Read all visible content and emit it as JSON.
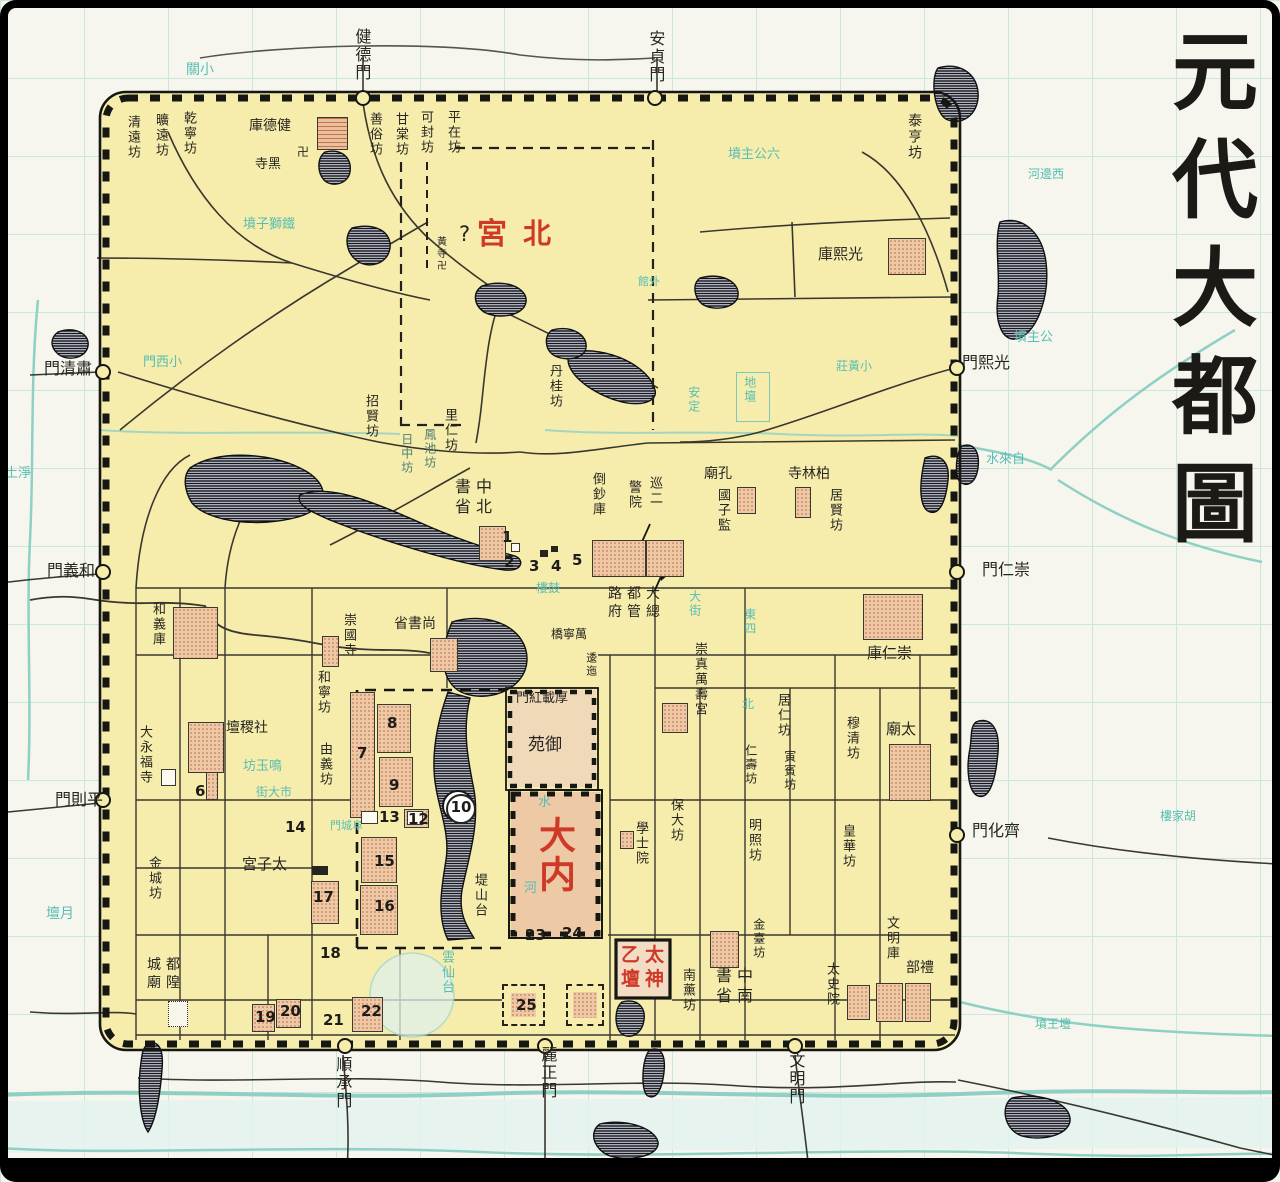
{
  "title": {
    "text": "元代大都圖",
    "chars": [
      "元",
      "代",
      "大",
      "都",
      "圖"
    ]
  },
  "colors": {
    "ink": "#26251f",
    "red": "#cf3a28",
    "teal": "#58bdb2",
    "grayteal": "#4f7d74",
    "city_fill": "#f6edad",
    "paper": "#f6f6ee",
    "wall": "#161613",
    "road": "#3a372f",
    "water_line": "#8fd0c5",
    "lake_hatch": "#16161e",
    "block_fill": "#eec9a6"
  },
  "legend_note": "numbered sites 1-25 marked on map",
  "labels": [
    {
      "id": "gate-jiande",
      "t": "健德門",
      "x": 352,
      "y": 28,
      "v": 1,
      "s": 16
    },
    {
      "id": "gate-anzhen",
      "t": "安貞門",
      "x": 646,
      "y": 30,
      "v": 1,
      "s": 16
    },
    {
      "id": "gate-suqing",
      "t": "門清肅",
      "x": 44,
      "y": 360,
      "s": 16
    },
    {
      "id": "gate-heyi",
      "t": "門義和",
      "x": 47,
      "y": 562,
      "s": 16
    },
    {
      "id": "gate-pingze",
      "t": "門則平",
      "x": 55,
      "y": 791,
      "s": 16
    },
    {
      "id": "gate-guangxi",
      "t": "門熙光",
      "x": 962,
      "y": 354,
      "s": 16
    },
    {
      "id": "gate-chongren",
      "t": "門仁崇",
      "x": 982,
      "y": 561,
      "s": 16
    },
    {
      "id": "gate-qihua",
      "t": "門化齊",
      "x": 972,
      "y": 822,
      "s": 16
    },
    {
      "id": "gate-shuncheng",
      "t": "順承門",
      "x": 333,
      "y": 1056,
      "v": 1,
      "s": 16
    },
    {
      "id": "gate-lizheng",
      "t": "麗正門",
      "x": 538,
      "y": 1046,
      "v": 1,
      "s": 16
    },
    {
      "id": "gate-wenming",
      "t": "文明門",
      "x": 786,
      "y": 1052,
      "v": 1,
      "s": 16
    },
    {
      "id": "ward-qingyuan",
      "t": "清遠坊",
      "x": 124,
      "y": 115,
      "v": 1,
      "s": 13
    },
    {
      "id": "ward-kuangyuan",
      "t": "曠遠坊",
      "x": 152,
      "y": 113,
      "v": 1,
      "s": 13
    },
    {
      "id": "ward-qianning",
      "t": "乾寧坊",
      "x": 180,
      "y": 111,
      "v": 1,
      "s": 13
    },
    {
      "id": "ward-shansu",
      "t": "善俗坊",
      "x": 366,
      "y": 112,
      "v": 1,
      "s": 13
    },
    {
      "id": "ward-gantang",
      "t": "甘棠坊",
      "x": 392,
      "y": 112,
      "v": 1,
      "s": 13
    },
    {
      "id": "ward-kefeng",
      "t": "可封坊",
      "x": 417,
      "y": 110,
      "v": 1,
      "s": 13
    },
    {
      "id": "ward-pingzai",
      "t": "平在坊",
      "x": 444,
      "y": 110,
      "v": 1,
      "s": 13
    },
    {
      "id": "ward-taiheng",
      "t": "泰亨坊",
      "x": 906,
      "y": 113,
      "v": 1,
      "s": 14
    },
    {
      "id": "ward-zhaoxian",
      "t": "招賢坊",
      "x": 362,
      "y": 394,
      "v": 1,
      "s": 13
    },
    {
      "id": "ward-liren",
      "t": "里仁坊",
      "x": 441,
      "y": 408,
      "v": 1,
      "s": 13
    },
    {
      "id": "ward-dangui",
      "t": "丹桂坊",
      "x": 546,
      "y": 364,
      "v": 1,
      "s": 13
    },
    {
      "id": "ward-fengchi",
      "t": "鳳池坊",
      "x": 422,
      "y": 428,
      "v": 1,
      "s": 12,
      "c": "g"
    },
    {
      "id": "ward-rizhong",
      "t": "日中坊",
      "x": 399,
      "y": 433,
      "v": 1,
      "s": 12,
      "c": "g"
    },
    {
      "id": "ward-hening",
      "t": "和寧坊",
      "x": 314,
      "y": 670,
      "v": 1,
      "s": 13
    },
    {
      "id": "ward-youyi",
      "t": "由義坊",
      "x": 316,
      "y": 742,
      "v": 1,
      "s": 13
    },
    {
      "id": "ward-juxian",
      "t": "居賢坊",
      "x": 826,
      "y": 488,
      "v": 1,
      "s": 13
    },
    {
      "id": "ward-juren",
      "t": "居仁坊",
      "x": 774,
      "y": 693,
      "v": 1,
      "s": 13
    },
    {
      "id": "ward-yinbin",
      "t": "寅賓坊",
      "x": 782,
      "y": 750,
      "v": 1,
      "s": 12
    },
    {
      "id": "ward-renshou",
      "t": "仁壽坊",
      "x": 743,
      "y": 744,
      "v": 1,
      "s": 12
    },
    {
      "id": "ward-mingzhao",
      "t": "明照坊",
      "x": 745,
      "y": 818,
      "v": 1,
      "s": 13
    },
    {
      "id": "ward-muqing",
      "t": "穆清坊",
      "x": 843,
      "y": 716,
      "v": 1,
      "s": 13
    },
    {
      "id": "ward-huanghua",
      "t": "皇華坊",
      "x": 839,
      "y": 824,
      "v": 1,
      "s": 13
    },
    {
      "id": "ward-baoda",
      "t": "保大坊",
      "x": 667,
      "y": 798,
      "v": 1,
      "s": 13
    },
    {
      "id": "ward-jintai",
      "t": "金臺坊",
      "x": 751,
      "y": 918,
      "v": 1,
      "s": 12
    },
    {
      "id": "ward-nanxun",
      "t": "南薰坊",
      "x": 679,
      "y": 968,
      "v": 1,
      "s": 13
    },
    {
      "id": "ward-jincheng",
      "t": "金城坊",
      "x": 145,
      "y": 856,
      "v": 1,
      "s": 13
    },
    {
      "id": "site-dishantai",
      "t": "堤山台",
      "x": 471,
      "y": 873,
      "v": 1,
      "s": 13
    },
    {
      "id": "bld-jiandeku",
      "t": "庫德健",
      "x": 249,
      "y": 118,
      "s": 14
    },
    {
      "id": "bld-heisi",
      "t": "寺黑",
      "x": 255,
      "y": 158,
      "s": 13
    },
    {
      "id": "icon-swastika-1",
      "t": "卍",
      "x": 297,
      "y": 146,
      "s": 12
    },
    {
      "id": "bld-guangxiku",
      "t": "庫熙光",
      "x": 818,
      "y": 246,
      "s": 15
    },
    {
      "id": "bld-zhongshubeisheng",
      "rows": [
        "書中",
        "省北"
      ],
      "x": 455,
      "y": 477,
      "s": 16
    },
    {
      "id": "bld-daochaoku",
      "t": "倒鈔庫",
      "x": 589,
      "y": 472,
      "v": 1,
      "s": 13
    },
    {
      "id": "bld-xunjing-col1",
      "t": "巡二",
      "x": 646,
      "y": 476,
      "v": 1,
      "s": 13
    },
    {
      "id": "bld-xunjing-col2",
      "t": "警院",
      "x": 625,
      "y": 480,
      "v": 1,
      "s": 13
    },
    {
      "id": "bld-dadulu",
      "rows": [
        "路都大",
        "府管總"
      ],
      "x": 608,
      "y": 586,
      "s": 14
    },
    {
      "id": "bld-kongmiao",
      "t": "廟孔",
      "x": 704,
      "y": 466,
      "s": 14
    },
    {
      "id": "bld-guozijian",
      "t": "國子監",
      "x": 714,
      "y": 488,
      "v": 1,
      "s": 13
    },
    {
      "id": "bld-bailinsi",
      "t": "寺林柏",
      "x": 788,
      "y": 466,
      "s": 14
    },
    {
      "id": "bld-chongrenku",
      "t": "庫仁崇",
      "x": 867,
      "y": 645,
      "s": 15
    },
    {
      "id": "bld-taimiao",
      "t": "廟太",
      "x": 886,
      "y": 721,
      "s": 15
    },
    {
      "id": "bld-shangshusheng",
      "t": "省書尚",
      "x": 394,
      "y": 616,
      "s": 14
    },
    {
      "id": "bld-chongguosi",
      "t": "崇國寺",
      "x": 340,
      "y": 613,
      "v": 1,
      "s": 13
    },
    {
      "id": "bld-heyiku",
      "t": "和義庫",
      "x": 149,
      "y": 602,
      "v": 1,
      "s": 13
    },
    {
      "id": "bld-dayongfusi",
      "t": "大永福寺",
      "x": 136,
      "y": 725,
      "v": 1,
      "s": 13
    },
    {
      "id": "bld-shejitan",
      "t": "壇稷社",
      "x": 226,
      "y": 720,
      "s": 14
    },
    {
      "id": "bld-taizigong",
      "t": "宮子太",
      "x": 242,
      "y": 856,
      "s": 15
    },
    {
      "id": "bld-chenghuangmiao",
      "rows": [
        "城都",
        "廟隍"
      ],
      "x": 147,
      "y": 957,
      "s": 14
    },
    {
      "id": "bld-zhongshunansheng",
      "rows": [
        "書中",
        "省南"
      ],
      "x": 716,
      "y": 966,
      "s": 16
    },
    {
      "id": "bld-taishiyuan",
      "t": "太史院",
      "x": 823,
      "y": 962,
      "v": 1,
      "s": 13
    },
    {
      "id": "bld-wenmingku",
      "t": "文明庫",
      "x": 883,
      "y": 916,
      "v": 1,
      "s": 13
    },
    {
      "id": "bld-libu",
      "t": "部禮",
      "x": 906,
      "y": 960,
      "s": 14
    },
    {
      "id": "bld-xueshiyuan",
      "t": "學士院",
      "x": 632,
      "y": 821,
      "v": 1,
      "s": 13
    },
    {
      "id": "bld-chongzhen",
      "t": "崇真萬壽宮",
      "x": 691,
      "y": 642,
      "v": 1,
      "s": 13
    },
    {
      "id": "bld-wanningqiao",
      "t": "橋寧萬",
      "x": 551,
      "y": 628,
      "s": 12
    },
    {
      "id": "bld-weiyi",
      "t": "逶迤",
      "x": 584,
      "y": 652,
      "v": 1,
      "s": 11
    },
    {
      "id": "bld-houzaihongmen",
      "t": "門紅載厚",
      "x": 516,
      "y": 692,
      "s": 13
    },
    {
      "id": "bld-yuyuan",
      "t": "苑御",
      "x": 528,
      "y": 736,
      "s": 17
    },
    {
      "id": "bld-huangsi",
      "t": "黃寺卍",
      "x": 434,
      "y": 236,
      "v": 1,
      "s": 10
    },
    {
      "id": "red-gong",
      "t": "宮",
      "x": 477,
      "y": 218,
      "s": 30,
      "c": "r"
    },
    {
      "id": "red-bei",
      "t": "北",
      "x": 523,
      "y": 218,
      "s": 28,
      "c": "r"
    },
    {
      "id": "mark-question",
      "t": "?",
      "x": 459,
      "y": 222,
      "s": 21
    },
    {
      "id": "red-danei",
      "t": "大内",
      "x": 532,
      "y": 816,
      "v": 1,
      "s": 37,
      "c": "r"
    },
    {
      "id": "red-taiyi",
      "rows": [
        "乙太",
        "壇神"
      ],
      "x": 621,
      "y": 944,
      "s": 19,
      "c": "r"
    },
    {
      "id": "teal-xiaoguan",
      "t": "關小",
      "x": 186,
      "y": 62,
      "s": 14,
      "c": "t"
    },
    {
      "id": "teal-tieshizifen",
      "t": "墳子獅鐵",
      "x": 243,
      "y": 218,
      "s": 13,
      "c": "t"
    },
    {
      "id": "teal-liugongzhufen",
      "t": "墳主公六",
      "x": 728,
      "y": 148,
      "s": 13,
      "c": "t"
    },
    {
      "id": "teal-gongzhufen",
      "t": "墳主公",
      "x": 1014,
      "y": 331,
      "s": 13,
      "c": "t"
    },
    {
      "id": "teal-zilaishui",
      "t": "水來自",
      "x": 986,
      "y": 453,
      "s": 13,
      "c": "t"
    },
    {
      "id": "teal-xiaoximen",
      "t": "門西小",
      "x": 143,
      "y": 356,
      "s": 13,
      "c": "t"
    },
    {
      "id": "teal-yuetan",
      "t": "壇月",
      "x": 46,
      "y": 906,
      "s": 14,
      "c": "t"
    },
    {
      "id": "teal-mingyufang",
      "t": "坊玉鳴",
      "x": 243,
      "y": 760,
      "s": 13,
      "c": "t"
    },
    {
      "id": "teal-dashijie",
      "t": "街大市",
      "x": 256,
      "y": 786,
      "s": 12,
      "c": "t"
    },
    {
      "id": "teal-gulou",
      "t": "樓鼓",
      "x": 536,
      "y": 582,
      "s": 12,
      "c": "t"
    },
    {
      "id": "teal-ditan",
      "t": "地壇",
      "x": 742,
      "y": 376,
      "v": 1,
      "s": 12,
      "c": "t"
    },
    {
      "id": "teal-anding",
      "t": "安定",
      "x": 686,
      "y": 386,
      "v": 1,
      "s": 12,
      "c": "t"
    },
    {
      "id": "teal-yunxiantai",
      "t": "雲仙台",
      "x": 438,
      "y": 950,
      "v": 1,
      "s": 13,
      "c": "t"
    },
    {
      "id": "teal-dajie",
      "t": "大街",
      "x": 687,
      "y": 590,
      "v": 1,
      "s": 12,
      "c": "t"
    },
    {
      "id": "teal-dongsi",
      "t": "東四",
      "x": 742,
      "y": 608,
      "v": 1,
      "s": 12,
      "c": "t"
    },
    {
      "id": "teal-bei",
      "t": "北",
      "x": 742,
      "y": 698,
      "s": 12,
      "c": "t"
    },
    {
      "id": "teal-xiaohuangzhuang",
      "t": "莊黃小",
      "x": 836,
      "y": 360,
      "s": 12,
      "c": "t"
    },
    {
      "id": "teal-waiguan",
      "t": "館外",
      "x": 638,
      "y": 276,
      "s": 11,
      "c": "t"
    },
    {
      "id": "teal-fuchengmen",
      "t": "門城阜",
      "x": 330,
      "y": 820,
      "s": 11,
      "c": "t"
    },
    {
      "id": "teal-hujialou",
      "t": "樓家胡",
      "x": 1160,
      "y": 810,
      "s": 12,
      "c": "t"
    },
    {
      "id": "teal-wangtanfen",
      "t": "墳王壇",
      "x": 1035,
      "y": 1018,
      "s": 12,
      "c": "t"
    },
    {
      "id": "teal-xibianhe",
      "t": "河邊西",
      "x": 1028,
      "y": 168,
      "s": 12,
      "c": "t"
    },
    {
      "id": "teal-jingtu",
      "t": "土淨",
      "x": 5,
      "y": 467,
      "s": 13,
      "c": "t"
    },
    {
      "id": "teal-shui",
      "t": "水",
      "x": 538,
      "y": 796,
      "s": 13,
      "c": "t"
    },
    {
      "id": "teal-he",
      "t": "河",
      "x": 524,
      "y": 882,
      "s": 13,
      "c": "t"
    }
  ],
  "numbers": [
    {
      "n": "1",
      "x": 502,
      "y": 528
    },
    {
      "n": "2",
      "x": 504,
      "y": 553
    },
    {
      "n": "3",
      "x": 529,
      "y": 557
    },
    {
      "n": "4",
      "x": 551,
      "y": 557
    },
    {
      "n": "5",
      "x": 572,
      "y": 551
    },
    {
      "n": "6",
      "x": 195,
      "y": 782
    },
    {
      "n": "7",
      "x": 357,
      "y": 744
    },
    {
      "n": "8",
      "x": 387,
      "y": 714
    },
    {
      "n": "9",
      "x": 389,
      "y": 776
    },
    {
      "n": "10",
      "x": 446,
      "y": 794,
      "circ": 1
    },
    {
      "n": "12",
      "x": 408,
      "y": 810
    },
    {
      "n": "13",
      "x": 379,
      "y": 808
    },
    {
      "n": "14",
      "x": 285,
      "y": 818
    },
    {
      "n": "15",
      "x": 374,
      "y": 852
    },
    {
      "n": "16",
      "x": 374,
      "y": 897
    },
    {
      "n": "17",
      "x": 313,
      "y": 888
    },
    {
      "n": "18",
      "x": 320,
      "y": 944
    },
    {
      "n": "19",
      "x": 255,
      "y": 1008
    },
    {
      "n": "20",
      "x": 280,
      "y": 1002
    },
    {
      "n": "21",
      "x": 323,
      "y": 1011
    },
    {
      "n": "22",
      "x": 361,
      "y": 1002
    },
    {
      "n": "23",
      "x": 525,
      "y": 926
    },
    {
      "n": "24",
      "x": 562,
      "y": 924
    },
    {
      "n": "25",
      "x": 516,
      "y": 996
    }
  ],
  "blocks": [
    {
      "id": "jiandeku",
      "x": 317,
      "y": 117,
      "w": 31,
      "h": 33,
      "k": "ph"
    },
    {
      "id": "guangxiku",
      "x": 888,
      "y": 238,
      "w": 38,
      "h": 37,
      "k": "p"
    },
    {
      "id": "daochaoku",
      "x": 592,
      "y": 540,
      "w": 54,
      "h": 37,
      "k": "p"
    },
    {
      "id": "xunjingyuan",
      "x": 646,
      "y": 540,
      "w": 38,
      "h": 37,
      "k": "p"
    },
    {
      "id": "beisheng",
      "x": 479,
      "y": 526,
      "w": 27,
      "h": 35,
      "k": "p"
    },
    {
      "id": "kongmiao",
      "x": 737,
      "y": 487,
      "w": 19,
      "h": 27,
      "k": "p"
    },
    {
      "id": "bailinsi",
      "x": 795,
      "y": 487,
      "w": 16,
      "h": 31,
      "k": "p"
    },
    {
      "id": "chongrenku",
      "x": 863,
      "y": 594,
      "w": 60,
      "h": 46,
      "k": "p"
    },
    {
      "id": "taimiao",
      "x": 889,
      "y": 744,
      "w": 42,
      "h": 57,
      "k": "p"
    },
    {
      "id": "heyiku",
      "x": 173,
      "y": 607,
      "w": 45,
      "h": 52,
      "k": "p"
    },
    {
      "id": "shejitan",
      "x": 188,
      "y": 722,
      "w": 36,
      "h": 51,
      "k": "p"
    },
    {
      "id": "shejitan-tail",
      "x": 206,
      "y": 772,
      "w": 12,
      "h": 28,
      "k": "p"
    },
    {
      "id": "chongguosi",
      "x": 322,
      "y": 636,
      "w": 17,
      "h": 31,
      "k": "p"
    },
    {
      "id": "shangshusheng",
      "x": 430,
      "y": 638,
      "w": 28,
      "h": 34,
      "k": "p"
    },
    {
      "id": "palace-7",
      "x": 350,
      "y": 692,
      "w": 25,
      "h": 126,
      "k": "p"
    },
    {
      "id": "palace-8",
      "x": 377,
      "y": 704,
      "w": 34,
      "h": 49,
      "k": "p"
    },
    {
      "id": "palace-9",
      "x": 379,
      "y": 757,
      "w": 34,
      "h": 50,
      "k": "p"
    },
    {
      "id": "palace-12",
      "x": 404,
      "y": 809,
      "w": 25,
      "h": 19,
      "k": "p"
    },
    {
      "id": "palace-12-box",
      "x": 407,
      "y": 811,
      "w": 16,
      "h": 14,
      "k": "w"
    },
    {
      "id": "palace-13-box",
      "x": 361,
      "y": 811,
      "w": 17,
      "h": 13,
      "k": "w"
    },
    {
      "id": "palace-15",
      "x": 361,
      "y": 837,
      "w": 36,
      "h": 46,
      "k": "p"
    },
    {
      "id": "palace-16",
      "x": 360,
      "y": 885,
      "w": 38,
      "h": 50,
      "k": "p"
    },
    {
      "id": "palace-17",
      "x": 311,
      "y": 881,
      "w": 28,
      "h": 43,
      "k": "p"
    },
    {
      "id": "xueshiyuan",
      "x": 620,
      "y": 831,
      "w": 14,
      "h": 18,
      "k": "p"
    },
    {
      "id": "wanshougong",
      "x": 662,
      "y": 703,
      "w": 26,
      "h": 30,
      "k": "p"
    },
    {
      "id": "nansheng",
      "x": 710,
      "y": 931,
      "w": 29,
      "h": 37,
      "k": "p"
    },
    {
      "id": "taishiyuan",
      "x": 847,
      "y": 985,
      "w": 23,
      "h": 35,
      "k": "p"
    },
    {
      "id": "libu-1",
      "x": 876,
      "y": 983,
      "w": 27,
      "h": 39,
      "k": "p"
    },
    {
      "id": "libu-2",
      "x": 905,
      "y": 983,
      "w": 26,
      "h": 39,
      "k": "p"
    },
    {
      "id": "site-22",
      "x": 352,
      "y": 997,
      "w": 31,
      "h": 35,
      "k": "p"
    },
    {
      "id": "site-19",
      "x": 252,
      "y": 1004,
      "w": 23,
      "h": 28,
      "k": "p"
    },
    {
      "id": "site-20",
      "x": 276,
      "y": 999,
      "w": 25,
      "h": 29,
      "k": "p"
    },
    {
      "id": "chenghuangmiao",
      "x": 168,
      "y": 1001,
      "w": 20,
      "h": 26,
      "k": "dot"
    },
    {
      "id": "yongfusi-box",
      "x": 161,
      "y": 769,
      "w": 15,
      "h": 17,
      "k": "w"
    },
    {
      "id": "site-25-dash",
      "x": 502,
      "y": 984,
      "w": 43,
      "h": 42,
      "k": "d"
    },
    {
      "id": "site-25-fill",
      "x": 511,
      "y": 993,
      "w": 25,
      "h": 24,
      "k": "pd"
    },
    {
      "id": "site-25b-dash",
      "x": 566,
      "y": 984,
      "w": 38,
      "h": 42,
      "k": "d"
    },
    {
      "id": "site-25b-fill",
      "x": 573,
      "y": 992,
      "w": 24,
      "h": 26,
      "k": "pd"
    },
    {
      "id": "taizigong-tick",
      "x": 312,
      "y": 866,
      "w": 16,
      "h": 9,
      "k": "black"
    },
    {
      "id": "num1-box",
      "x": 511,
      "y": 543,
      "w": 9,
      "h": 9,
      "k": "w"
    },
    {
      "id": "num3-box",
      "x": 540,
      "y": 550,
      "w": 8,
      "h": 7,
      "k": "black"
    },
    {
      "id": "num4-box",
      "x": 551,
      "y": 546,
      "w": 7,
      "h": 6,
      "k": "black"
    },
    {
      "id": "ditan-square",
      "x": 736,
      "y": 372,
      "w": 34,
      "h": 50,
      "k": "tealbox"
    }
  ]
}
